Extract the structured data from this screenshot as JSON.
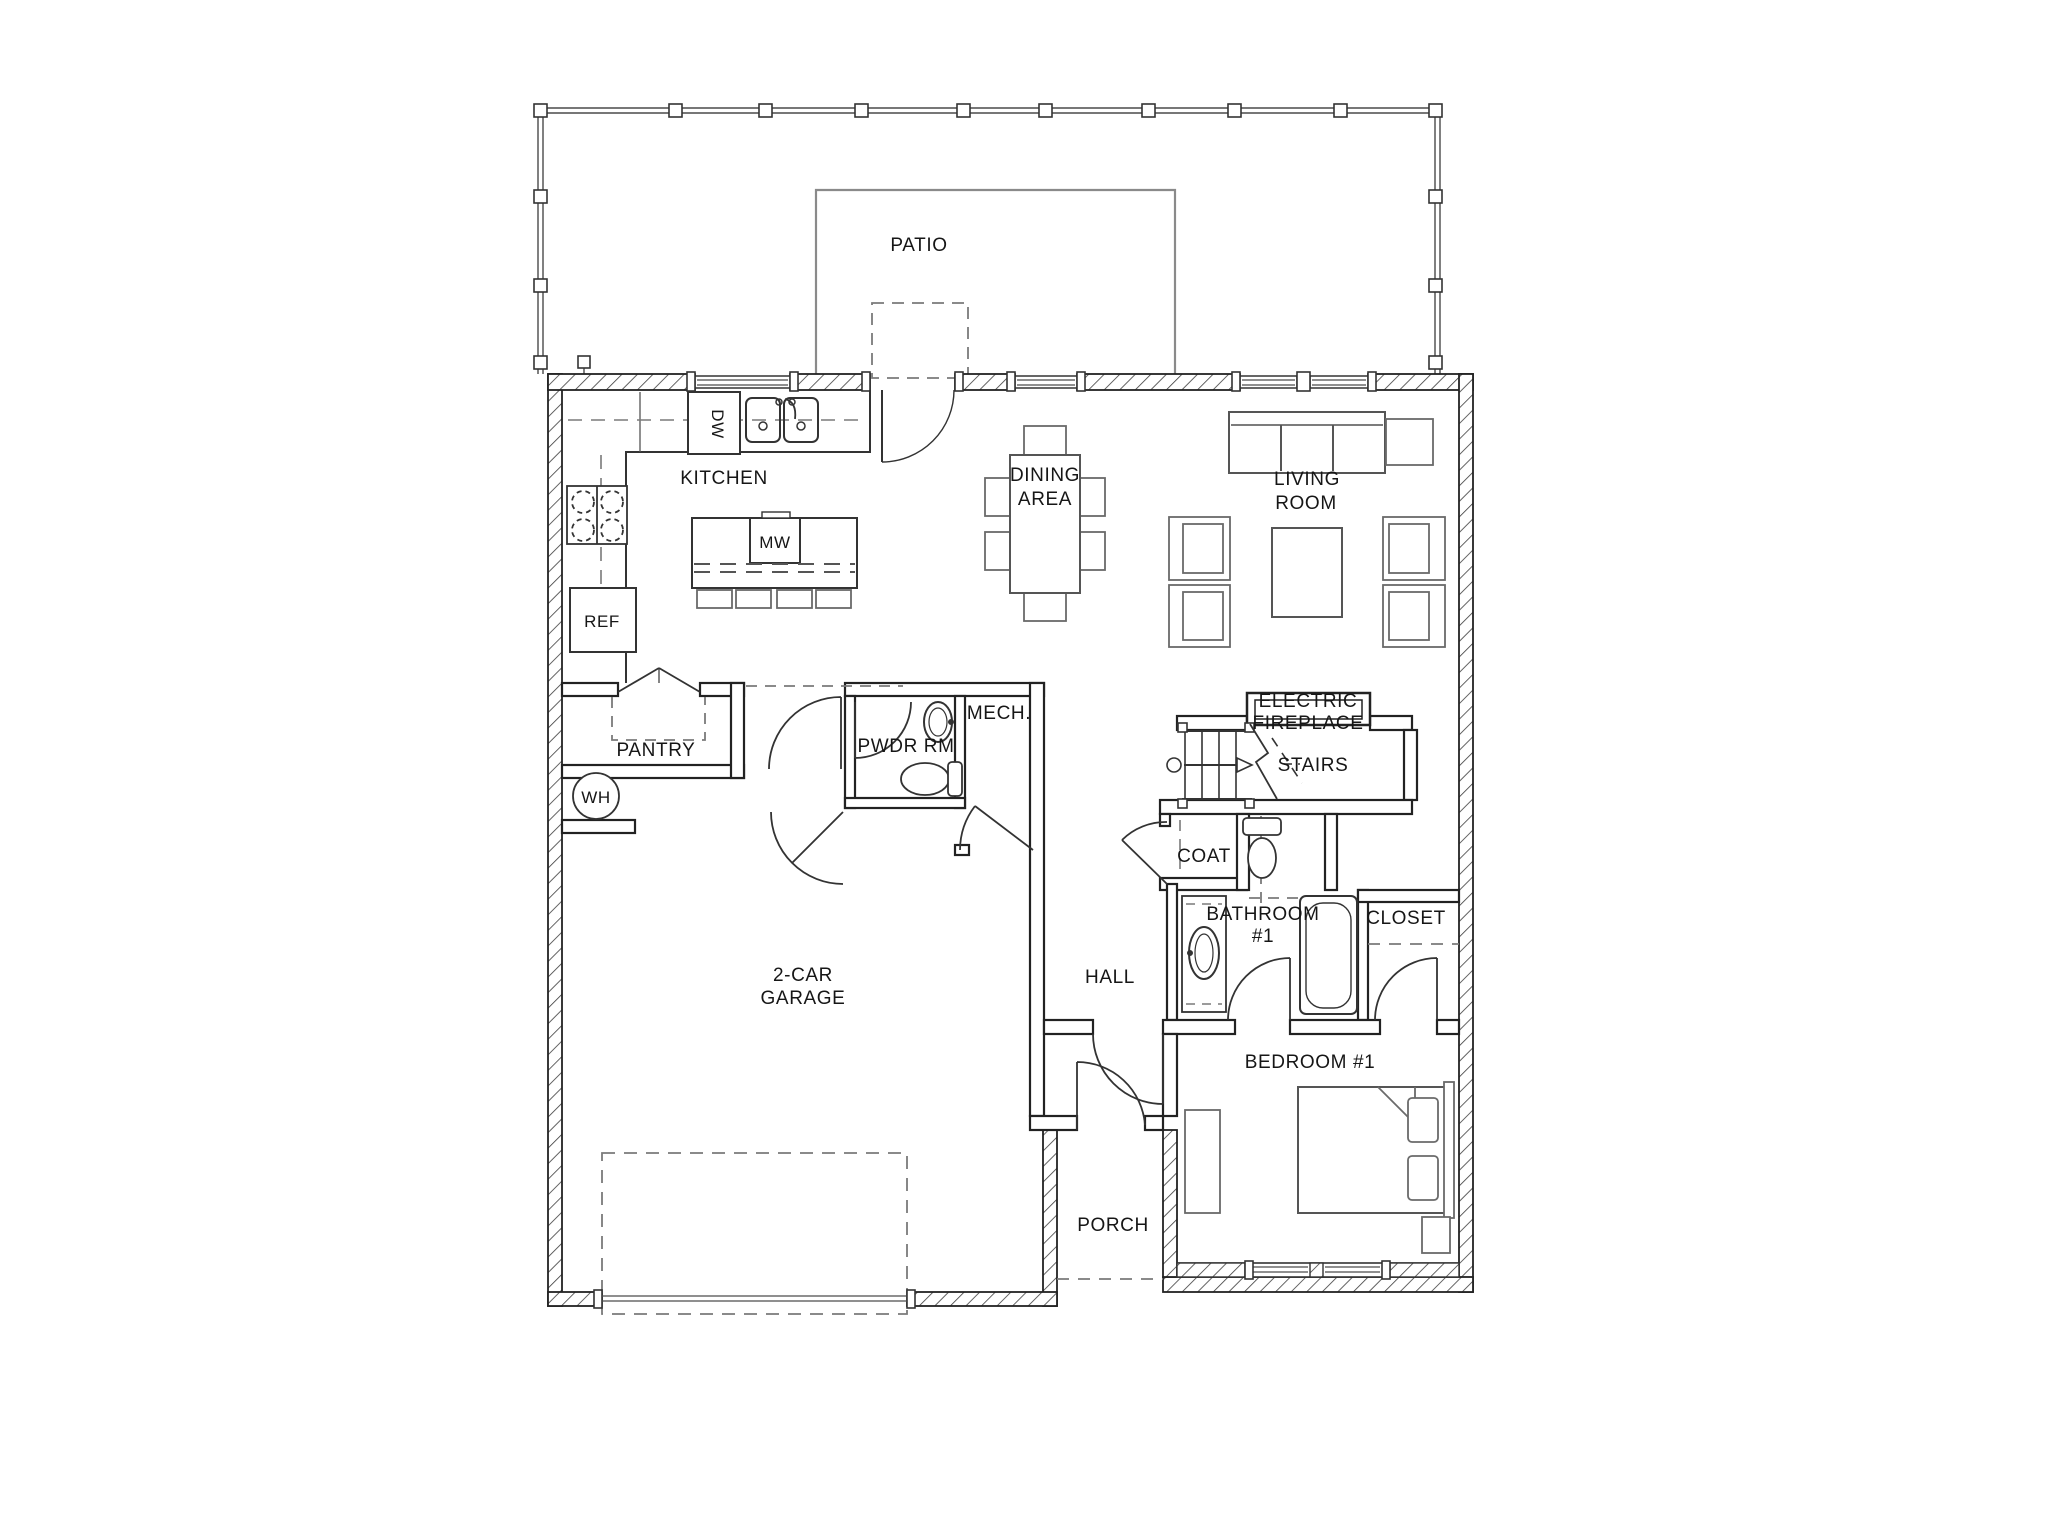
{
  "title": "First floor residential floor plan",
  "colors": {
    "ink": "#222222",
    "wall_hatch": "#3c3c3c",
    "furniture": "#6a6a6a",
    "glazing": "#8f8f8f",
    "dashed": "#7a7a7a",
    "background": "#ffffff"
  },
  "labels": {
    "patio": "PATIO",
    "kitchen": "KITCHEN",
    "dw": "DW",
    "mw": "MW",
    "ref": "REF",
    "dining_line1": "DINING",
    "dining_line2": "AREA",
    "living_line1": "LIVING",
    "living_line2": "ROOM",
    "fireplace_line1": "ELECTRIC",
    "fireplace_line2": "FIREPLACE",
    "stairs": "STAIRS",
    "pantry": "PANTRY",
    "wh": "WH",
    "pwdr": "PWDR RM",
    "mech": "MECH.",
    "coat": "COAT",
    "bath_line1": "BATHROOM",
    "bath_line2": "#1",
    "closet": "CLOSET",
    "hall": "HALL",
    "garage_line1": "2-CAR",
    "garage_line2": "GARAGE",
    "bedroom": "BEDROOM #1",
    "porch": "PORCH"
  }
}
